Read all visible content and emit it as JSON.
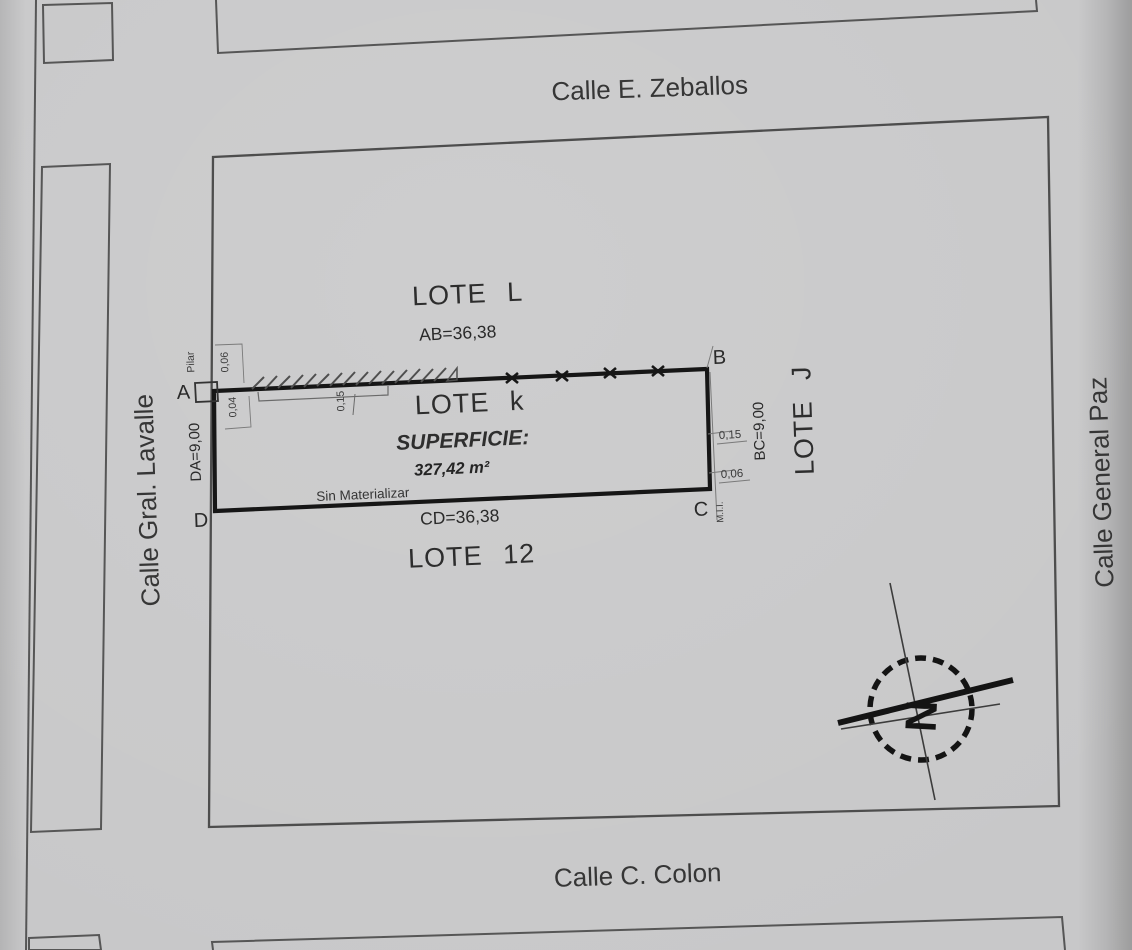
{
  "streets": {
    "top": "Calle E. Zeballos",
    "bottom": "Calle C. Colon",
    "left": "Calle Gral. Lavalle",
    "right": "Calle General Paz"
  },
  "lots": {
    "north": "LOTE L",
    "subject": "LOTE k",
    "east": "LOTE J",
    "south": "LOTE 12"
  },
  "corners": {
    "a": "A",
    "b": "B",
    "c": "C",
    "d": "D"
  },
  "dimensions": {
    "ab": "AB=36,38",
    "cd": "CD=36,38",
    "da": "DA=9,00",
    "bc": "BC=9,00"
  },
  "area": {
    "label": "SUPERFICIE:",
    "value": "327,42 m²"
  },
  "annotations": {
    "pillar": "Pilar",
    "offset_a_top": "0,06",
    "offset_a_bottom": "0,04",
    "wall_thickness": "0,15",
    "offset_b": "0,15",
    "offset_c": "0,06",
    "boundary_mark": "M.I.I.",
    "unmaterialized": "Sin Materializar",
    "north_letter": "N"
  },
  "colors": {
    "paper": "#c8c8c9",
    "ink": "#1b1b1b",
    "outline": "#4d4d4d"
  }
}
